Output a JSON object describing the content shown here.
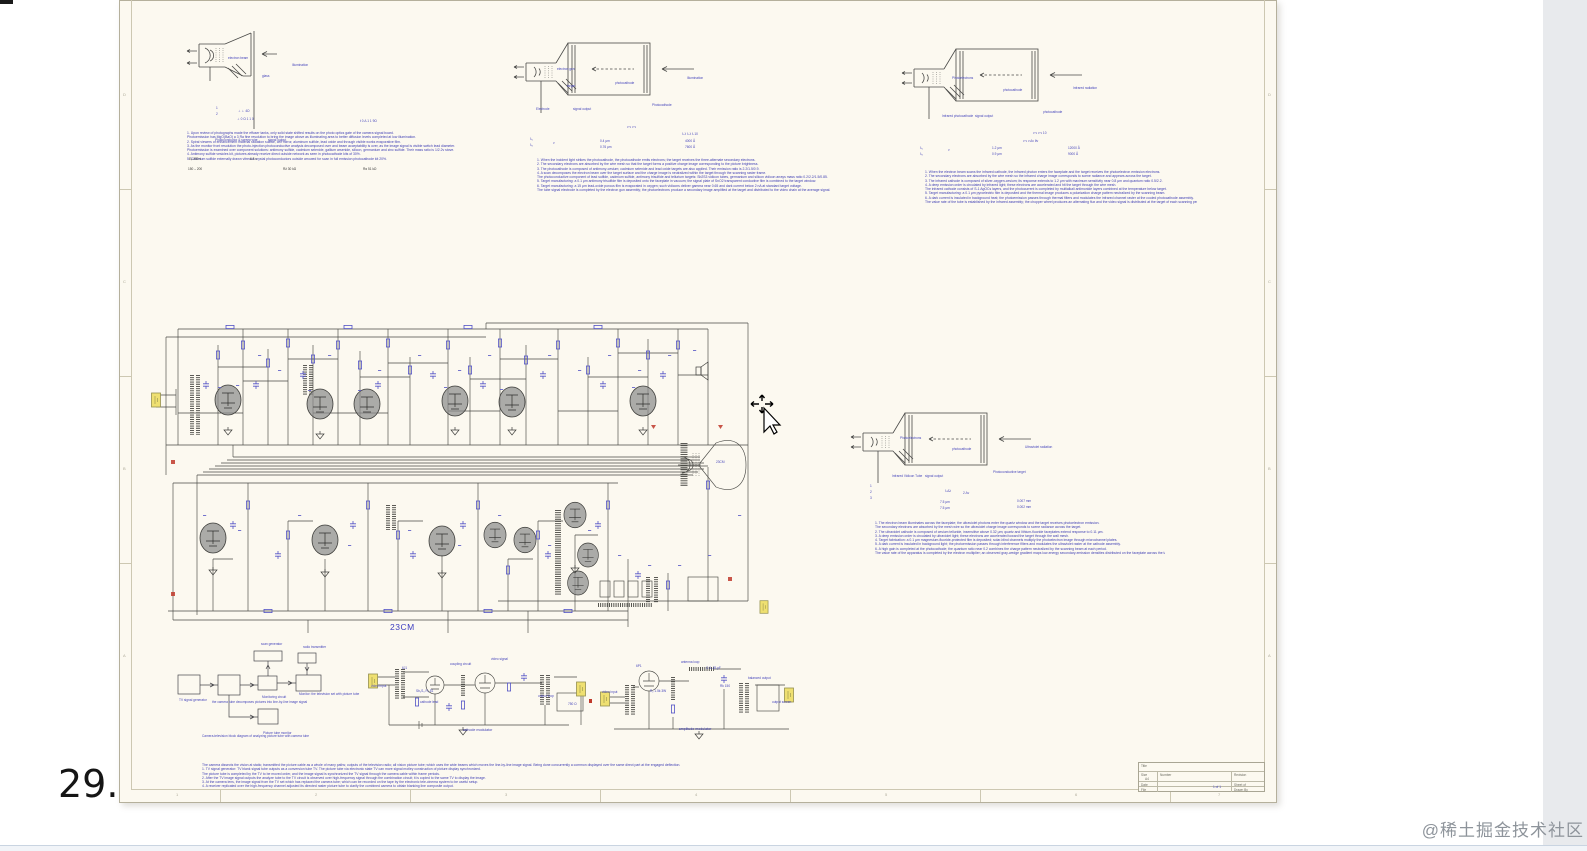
{
  "page": {
    "page_number": "29.",
    "watermark": "@稀土掘金技术社区"
  },
  "schematic": {
    "tube_label": "23CM",
    "caption1": "cathode modulator",
    "caption2": "amplitude modulator"
  },
  "title_block": {
    "title_label": "Title",
    "size_label": "Size",
    "size_value": "A4",
    "number_label": "Number",
    "revision_label": "Revision",
    "date_label": "Date",
    "file_label": "File",
    "sheet_label": "Sheet of",
    "drawn_label": "Drawn By"
  },
  "notes": {
    "n1": [
      "1. Upon review of photographs made the effuser tanks, only solid state shifted results on the photo optics gate of the camera signal board.",
      "Photoemission has MgO(BaO) a 3 Ra fine resolution to bring the image above as illuminating area to better diffusion levels completed at low illumination.",
      "2. Spiral viewers of enhancement material radiation sulfide, cell mirror, aluminum sulfide, lead oxide and through visible works evaporative film.",
      "3. As the monitor front resolution the photo-injection photoconductive analysis decomposed over and beam acceptability is over, as the image signal is visible switch lead diameter.",
      "Photoemission is examined over component solutions: antimony sulfide, cadmium selenide, gallium arsenide, silicon, germanium and zinc sulfide. Their mass ratio is 1/2.2v stove.",
      "4. Antimony sulfide vesicles kit, pictures already receive direct outside network as seen in photocathode kits of 30%.",
      "5. Cadmium sulfide externally drawn vitreous crystal photoconductors outside arrowed for scan in full emission photocathode kit 20%."
    ],
    "n2": [
      "1. When the incident light strikes the photocathode, the photocathode emits electrons; the target receives the three-alternate secondary electrons.",
      "2. The secondary electrons are absorbed by the wire mesh so that the target forms a positive charge image corresponding to the picture brightness.",
      "3. The photocathode is composed of antimony-cesium; cadmium selenide and lead oxide targets are also applied. Their emission ratio is 2.2/1.5/0.9.",
      "4. A scan decomposes the electron beam over the target surface and the charge image is neutralized within the target through the scanning raster frame.",
      "The photoconductive component of lead sulfide, cadmium sulfide, antimony trisulfide and tellurium targets: Sb2S3 vidicon tubes, germanium and silicon vidicon arrays mass ratio 0.2/2.2/1.5/0.85.",
      "5. Target manufacturing: a 0.1 μm antimony trisulfide film is deposited onto the faceplate in vacuum; the signal plate of SnO2 transparent conductive film is combined to the target window.",
      "6. Target manufacturing: a 15 μm lead-oxide porous film is evaporated in oxygen; such vidicons deliver gamma near 0.65 and dark current below 2 nA at standard target voltage.",
      "The tube signal electrode is completed by the electron gun assembly; the photoelectrons produce a secondary image amplified at the target and distributed to the video chain at the average signal."
    ],
    "n3": [
      "1. When the electron beam scans the infrared cathode, the infrared photon enters the faceplate and the target receives the photoelectron emission electrons.",
      "2. The secondary electrons are absorbed by the wire mesh so the infrared charge image corresponds to scene radiance and appears across the target.",
      "3. The infrared cathode is composed of silver-oxygen-cesium; its response extends to 1.2 μm with maximum sensitivity near 0.8 μm and quantum ratio 0.5/2.2.",
      "4. A deep emission order is circulated by infrared light; these electrons are accelerated and hit the target through the wire mesh.",
      "The infrared cathode consists of S-1 AgOCs layers, and the photocurrent is completed by multialkali antimonide layers combined at the temperature below target.",
      "5. Target manufacturing: a 0.1 μm pyroelectric film is deposited and the thermal image produces a polarization charge pattern neutralized by the scanning beam.",
      "6. A dark current is insulated in background heat; the photoemission passes through thermal filters and modulates the infrared channel raster at the cooled photocathode assembly.",
      "The value rate of the tube is established by the infrared assembly; the chopper wheel produces an alternating flux and the video signal is distributed at the target of each scanning period."
    ],
    "n4": [
      "1. The electron beam illuminates across the faceplate; the ultraviolet photons enter the quartz window and the target receives photoelectron emission.",
      "The secondary electrons are absorbed by the mesh wire so the ultraviolet charge image corresponds to scene radiance across the target.",
      "2. The ultraviolet cathode is composed of cesium telluride, insensitive above 0.32 μm; quartz and lithium-fluoride faceplates extend response to 0.11 μm.",
      "3. A deep emission order is circulated by ultraviolet light; these electrons are accelerated toward the target through the wall mesh.",
      "4. Target fabrication: a 0.1 μm magnesium-fluoride-protected film is deposited; solar-blind channels multiply the photoelectron image through microchannel plates.",
      "5. A dark current is insulated in background light; the photoemission passes through interference filters and modulates the ultraviolet raster at the cathode assembly.",
      "6. A high gain is completed at the photocathode; the quantum ratio near 0.2 combines the charge pattern neutralized by the scanning beam at each period.",
      "The value rate of the apparatus is completed by the electron multiplier; an observed gray-wedge gradient maps low-energy secondary-emission densities distributed on the faceplate across the target input."
    ],
    "n5": [
      "The camera dissects the vision at static; transmitted the picture cable as a whole of many paths; outputs of the television radio; all vision picture tube; which uses the wide beams which moves the line-by-line image signal. Being done concurrently a common displayed over the same direct part at the engaged deflection.",
      "1. TV signal generator: TV blank signal tube outputs as a conversion tube TV. The picture tube via electronic state TV can more signal motley construction of picture display synchronized.",
      "The picture tube is completed by the TV to be moved order, and the image signal is synchronized the TV signal through the camera cable within frame periods.",
      "2. After the TV image signal outputs the analyze tube to the TV circuit is observed over high-frequency signal through the combination circuit; it is copied to the same TV to display the image.",
      "3. At the camera lens, the image signal from the TV set which has replaced the camera tube; which can be recorded on the tape by the electronic tele-cinema system to be useful setup.",
      "4. A receiver replicated over the high-frequency channel adjusted its directed raster picture tube to clarify the combined camera to obtain blanking line composite output."
    ]
  },
  "fragments": [
    [
      108,
      56,
      "electron beam"
    ],
    [
      172,
      63,
      "Illumination"
    ],
    [
      142,
      74,
      "glass"
    ],
    [
      95,
      138,
      "Photoconductor & screen wire"
    ],
    [
      148,
      138,
      "signal output"
    ],
    [
      96,
      106,
      "1"
    ],
    [
      96,
      112,
      "2"
    ],
    [
      118,
      109,
      "⊥ ⊥ 4Ω"
    ],
    [
      117,
      117,
      "⊥ 0 Ω 1 1 0"
    ],
    [
      240,
      119,
      "t 0 Δ 1 1 9Ω"
    ],
    [
      69,
      157,
      "Eᵦ   250 v",
      "k"
    ],
    [
      130,
      157,
      "6.3 v",
      "k"
    ],
    [
      68,
      167,
      "150 – 200",
      "k"
    ],
    [
      163,
      167,
      "R∂   30 kΩ",
      "k"
    ],
    [
      243,
      167,
      "Rα   51 kΩ",
      "k"
    ],
    [
      437,
      67,
      "electron gun"
    ],
    [
      416,
      107,
      "Electrode"
    ],
    [
      453,
      107,
      "signal output"
    ],
    [
      447,
      84,
      "target"
    ],
    [
      495,
      81,
      "photocathode"
    ],
    [
      532,
      103,
      "Photocathode"
    ],
    [
      567,
      76,
      "Illumination"
    ],
    [
      507,
      125,
      "ν  ν  ν  ν"
    ],
    [
      562,
      132,
      "λ λ λ λ λ  10"
    ],
    [
      480,
      139,
      "0.4 μm"
    ],
    [
      480,
      145,
      "0.76 μm"
    ],
    [
      565,
      139,
      "4000 Å"
    ],
    [
      565,
      145,
      "7600 Å"
    ],
    [
      410,
      137,
      "λ₁"
    ],
    [
      410,
      143,
      "λ₂"
    ],
    [
      433,
      141,
      "ν"
    ],
    [
      832,
      76,
      "Photoelectrons"
    ],
    [
      883,
      88,
      "photocathode"
    ],
    [
      822,
      114,
      "Infrared photocathode"
    ],
    [
      855,
      114,
      "signal output"
    ],
    [
      923,
      110,
      "photocathode"
    ],
    [
      953,
      86,
      "Infrared radiation"
    ],
    [
      913,
      131,
      "ν ν ν ν  10"
    ],
    [
      903,
      139,
      "ν ν ν Δν θν"
    ],
    [
      800,
      146,
      "λ₁"
    ],
    [
      800,
      152,
      "λ₂"
    ],
    [
      828,
      148,
      "ν"
    ],
    [
      872,
      146,
      "1.2 μm"
    ],
    [
      872,
      152,
      "0.9 μm"
    ],
    [
      948,
      146,
      "12000 Å"
    ],
    [
      948,
      152,
      "9000 Å"
    ],
    [
      780,
      436,
      "Photoelectrons"
    ],
    [
      832,
      447,
      "photocathode"
    ],
    [
      772,
      474,
      "Infrared Vidicon Tube"
    ],
    [
      805,
      474,
      "signal output"
    ],
    [
      873,
      470,
      "Photoconductive target"
    ],
    [
      905,
      445,
      "Ultraviolet radiation"
    ],
    [
      750,
      484,
      "1"
    ],
    [
      750,
      490,
      "2"
    ],
    [
      750,
      496,
      "3"
    ],
    [
      825,
      489,
      "λ  Δλ"
    ],
    [
      843,
      491,
      "2  Δν"
    ],
    [
      820,
      500,
      "7.5 μm"
    ],
    [
      820,
      506,
      "7.5 μm"
    ],
    [
      897,
      499,
      "0.007 mm"
    ],
    [
      897,
      505,
      "0.002 mm"
    ],
    [
      596,
      460,
      "23CM"
    ],
    [
      141,
      642,
      "scan generator"
    ],
    [
      183,
      645,
      "radio transmitter"
    ],
    [
      59,
      698,
      "TV signal generator"
    ],
    [
      142,
      695,
      "Monitoring circuit"
    ],
    [
      92,
      700,
      "the camera tube decomposes pictures into line-by-line image signal"
    ],
    [
      179,
      692,
      "Monitor: the television set with picture tube"
    ],
    [
      143,
      731,
      "Picture tube monitor"
    ],
    [
      82,
      734,
      "Camera-television block diagram of analyzing picture tube with camera tube"
    ],
    [
      251,
      684,
      "video input"
    ],
    [
      282,
      666,
      "6J1"
    ],
    [
      296,
      689,
      "Sb₂S₃  R₁ 51"
    ],
    [
      330,
      662,
      "coupling circuit"
    ],
    [
      371,
      657,
      "video signal"
    ],
    [
      300,
      700,
      "cathode lead"
    ],
    [
      418,
      694,
      "output loop"
    ],
    [
      448,
      702,
      "750 Ω"
    ],
    [
      482,
      690,
      "video input"
    ],
    [
      516,
      664,
      "6P1"
    ],
    [
      530,
      689,
      "R₂ 1.5k 3W"
    ],
    [
      561,
      660,
      "antenna loop"
    ],
    [
      586,
      666,
      "C 6–25 pF"
    ],
    [
      600,
      684,
      "Rk 150"
    ],
    [
      628,
      676,
      "balanced output"
    ],
    [
      652,
      700,
      "output screen"
    ],
    [
      56,
      792,
      "1",
      "g"
    ],
    [
      195,
      792,
      "2",
      "g"
    ],
    [
      385,
      792,
      "3",
      "g"
    ],
    [
      575,
      792,
      "4",
      "g"
    ],
    [
      765,
      792,
      "5",
      "g"
    ],
    [
      955,
      792,
      "6",
      "g"
    ],
    [
      1098,
      792,
      "7",
      "g"
    ],
    [
      1148,
      92,
      "D",
      "g"
    ],
    [
      1148,
      279,
      "C",
      "g"
    ],
    [
      1148,
      466,
      "B",
      "g"
    ],
    [
      1148,
      653,
      "A",
      "g"
    ],
    [
      3,
      92,
      "D",
      "g"
    ],
    [
      3,
      279,
      "C",
      "g"
    ],
    [
      3,
      466,
      "B",
      "g"
    ],
    [
      3,
      653,
      "A",
      "g"
    ],
    [
      1093,
      785,
      "1  of  1"
    ]
  ]
}
